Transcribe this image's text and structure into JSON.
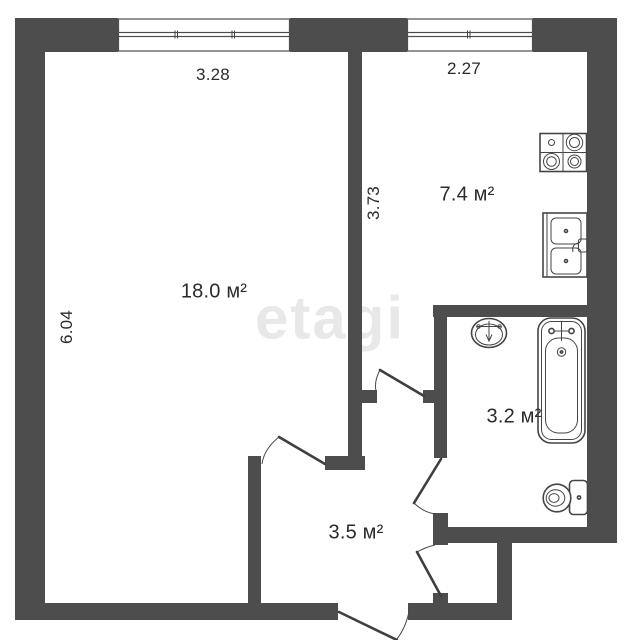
{
  "plan": {
    "title": "one-room apartment floor plan",
    "watermark": "etagi",
    "rooms": [
      {
        "id": "living-room",
        "area_label": "18.0 м²"
      },
      {
        "id": "kitchen",
        "area_label": "7.4 м²"
      },
      {
        "id": "bathroom",
        "area_label": "3.2 м²"
      },
      {
        "id": "hallway",
        "area_label": "3.5 м²"
      }
    ],
    "dimensions": [
      {
        "id": "living-room-window-width",
        "value": "3.28"
      },
      {
        "id": "kitchen-window-width",
        "value": "2.27"
      },
      {
        "id": "kitchen-depth",
        "value": "3.73"
      },
      {
        "id": "living-room-depth",
        "value": "6.04"
      }
    ],
    "icons": {
      "stove": "stove-icon",
      "kitchen_sink": "kitchen-sink-icon",
      "washbasin": "washbasin-icon",
      "bathtub": "bathtub-icon",
      "toilet": "toilet-icon",
      "doors": [
        "room-door-icon",
        "kitchen-door-icon",
        "bathroom-door-icon",
        "closet-door-icon",
        "entrance-door-icon"
      ],
      "windows": [
        "window-icon",
        "window-icon"
      ]
    },
    "colors": {
      "wall": "#4d4d4d",
      "line": "#3f3f3f",
      "text": "#2b2b2b",
      "watermark": "#e8e8e8",
      "background": "#ffffff"
    }
  }
}
